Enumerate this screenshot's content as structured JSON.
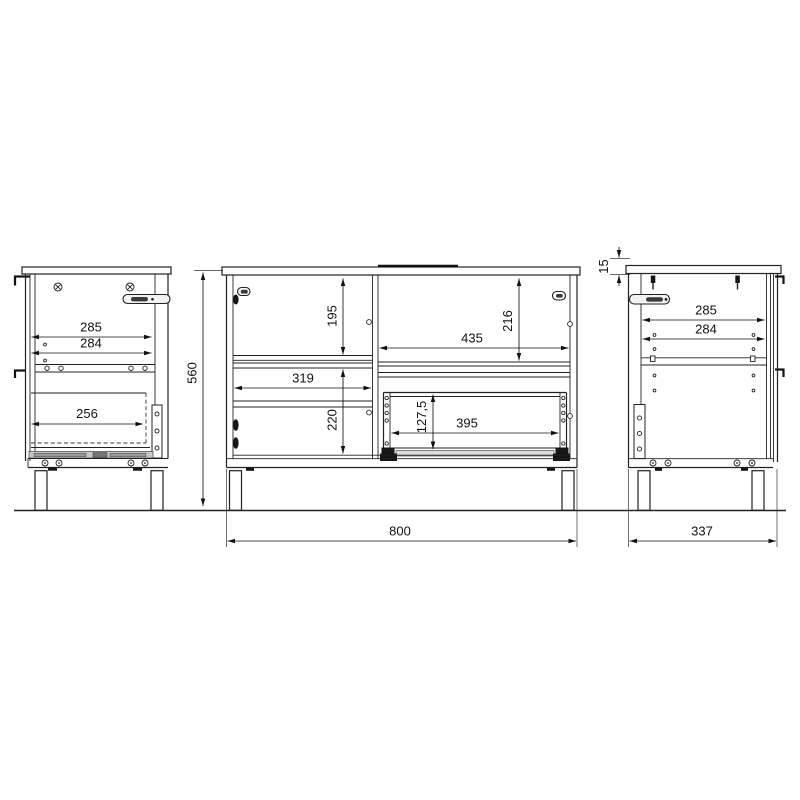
{
  "drawing": {
    "left_view": {
      "dim_285": "285",
      "dim_284": "284",
      "dim_256": "256"
    },
    "front_view": {
      "dim_560": "560",
      "dim_195": "195",
      "dim_319": "319",
      "dim_220": "220",
      "dim_216": "216",
      "dim_435": "435",
      "dim_127_5": "127,5",
      "dim_395": "395",
      "dim_800": "800"
    },
    "right_view": {
      "dim_15": "15",
      "dim_285": "285",
      "dim_284": "284",
      "dim_337": "337"
    }
  }
}
